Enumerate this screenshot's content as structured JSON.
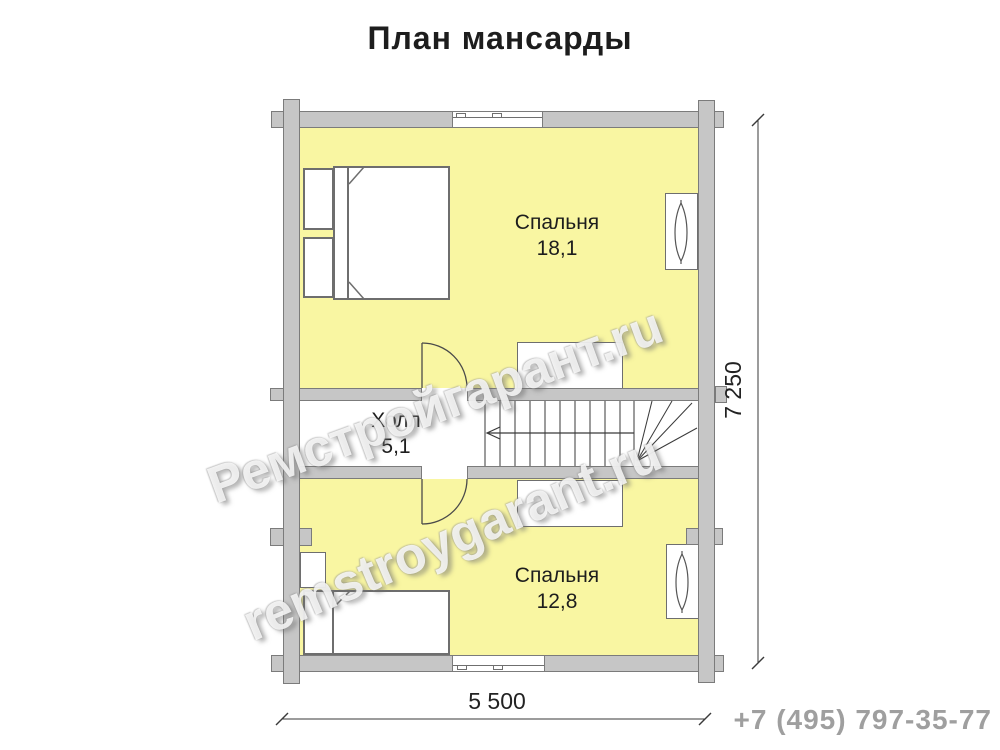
{
  "title": "План мансарды",
  "rooms": [
    {
      "name": "Спальня",
      "area": "18,1"
    },
    {
      "name": "Холл",
      "area": "5,1"
    },
    {
      "name": "Спальня",
      "area": "12,8"
    }
  ],
  "dimensions": {
    "overall_width": "5 500",
    "overall_depth": "7 250"
  },
  "watermark": {
    "line1": "Ремстройгарант.ru",
    "line2": "remstroygarant.ru"
  },
  "phone": "+7 (495) 797-35-77",
  "colors": {
    "room_fill": "#f9f6a2",
    "wall_fill": "#c6c6c6",
    "wall_border": "#7b7b7b",
    "phone_text": "#9f9f9f"
  }
}
